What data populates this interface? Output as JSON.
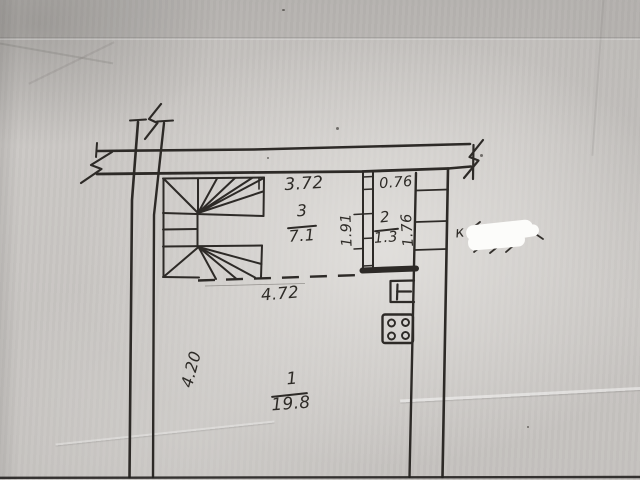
{
  "document": {
    "kind": "scanned floor plan photo",
    "paper_color": "#c9c6c3",
    "ink_color": "#2d2a27"
  },
  "rooms": [
    {
      "number": "1",
      "area": "19.8"
    },
    {
      "number": "2",
      "area": "1.3"
    },
    {
      "number": "3",
      "area": "7.1"
    }
  ],
  "dimensions": {
    "room3_width": "3.72",
    "room2_width": "0.76",
    "room2_depth_left": "1.91",
    "room2_depth_right": "1.76",
    "hall_opening": "4.72",
    "left_wall": "4.20"
  },
  "annotation": {
    "handwritten_remnant": "к"
  },
  "symbols": [
    {
      "name": "winder-staircase"
    },
    {
      "name": "gas-stove-4-burner"
    },
    {
      "name": "water-heater"
    },
    {
      "name": "dashed-boundary"
    },
    {
      "name": "wall-break-top-left"
    },
    {
      "name": "wall-break-left"
    },
    {
      "name": "wall-break-top-right"
    },
    {
      "name": "whiteout-correction"
    }
  ]
}
